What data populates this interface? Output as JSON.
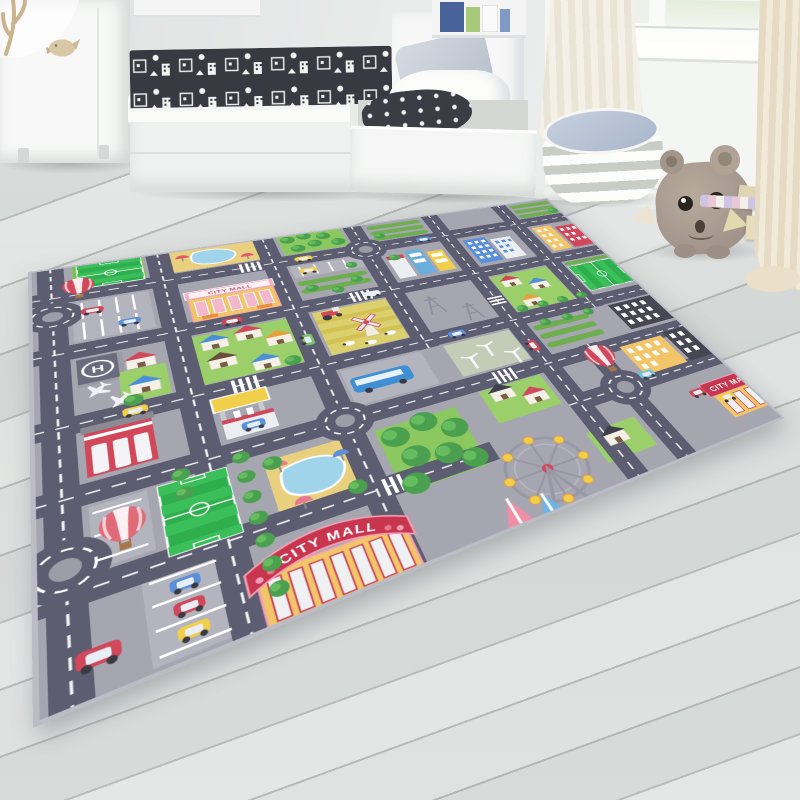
{
  "scene": {
    "type": "product-photo",
    "setting": "children's room with a city-road play rug on light gray wood floor",
    "objects": [
      "white wardrobe with bird handle",
      "white bed with storage drawers",
      "black-and-white doodle blanket",
      "gray pillow",
      "wall shelf with books",
      "window with sheer curtains",
      "gray-white striped pouf with blue top",
      "plush hippo toy",
      "wooden toy blocks",
      "city play rug"
    ]
  },
  "room": {
    "wardrobe": {
      "color": "#f7f8f7",
      "handle": "bird-shaped"
    },
    "pouf": {
      "stripe_colors": [
        "#fcfcfb",
        "#c9cdc5"
      ],
      "top_color": "#aab7cc"
    },
    "plush_toy": {
      "animal": "hippo",
      "color": "#a89a8d"
    },
    "floor": {
      "material": "wood planks",
      "color": "#dadddc"
    },
    "blanket": {
      "base": "#393941",
      "pattern": "white town doodles"
    }
  },
  "rug": {
    "signs": {
      "mall_top": "CITY MALL",
      "mall_front": "CITY MALL",
      "mall_corner": "CITY MALL"
    },
    "helipad_letter": "H",
    "features": [
      "road grid with white dashed lines",
      "5 roundabouts",
      "3 soccer fields",
      "2 ponds with umbrellas",
      "CITY MALL buildings",
      "hot air balloons",
      "ferris wheel",
      "windmill farm",
      "wind turbines",
      "helipad",
      "fire station",
      "gas station",
      "bus",
      "houses",
      "apartment blocks",
      "trees",
      "parked cars",
      "crosswalks"
    ],
    "colors": {
      "background": "#a6a6b1",
      "road": "#5d5d72",
      "road_line": "#ffffff",
      "grass": "#9bcf6a",
      "field_green": "#2fae4e",
      "sand": "#e9d07e",
      "pond": "#9fd4ea",
      "mall_yellow": "#f2c568",
      "sign_red": "#c8354f",
      "sign_pink": "#f4afc6",
      "balloon_red": "#d0485a"
    }
  }
}
